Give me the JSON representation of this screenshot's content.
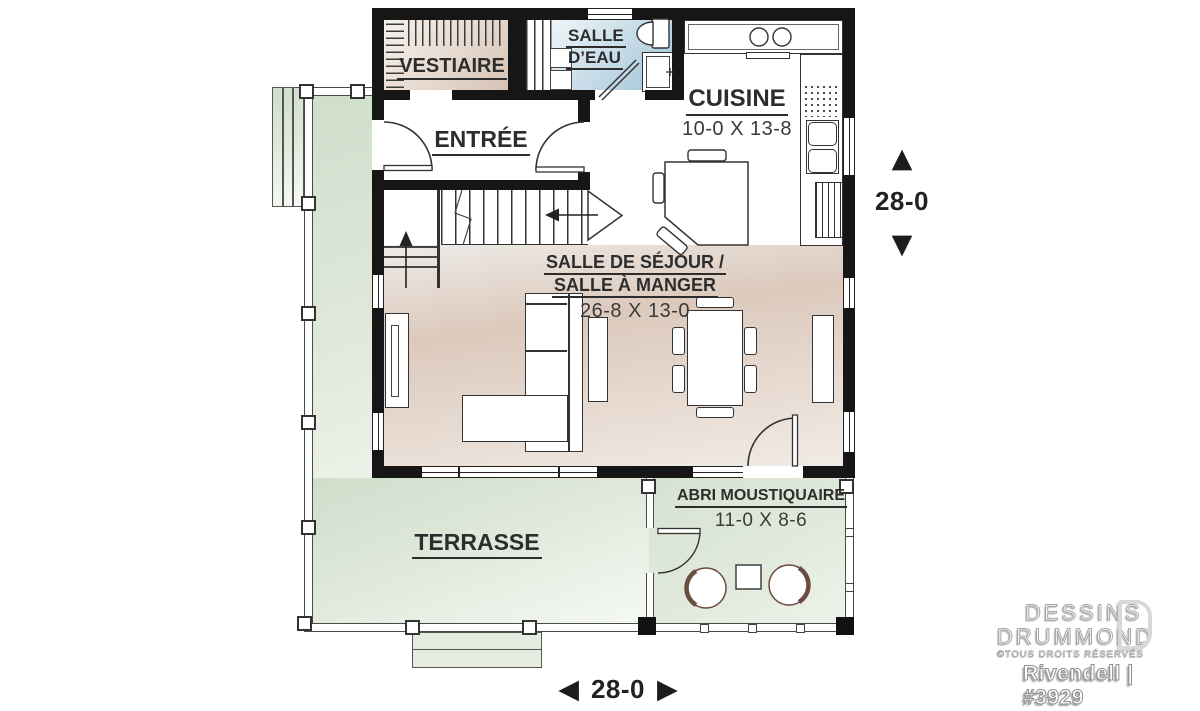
{
  "rooms": {
    "vestiaire": {
      "name": "VESTIAIRE"
    },
    "salle_deau": {
      "line1": "SALLE",
      "line2": "D’EAU"
    },
    "cuisine": {
      "name": "CUISINE",
      "dims": "10-0 X 13-8"
    },
    "entree": {
      "name": "ENTRÉE"
    },
    "sejour": {
      "line1": "SALLE DE SÉJOUR /",
      "line2": "SALLE À MANGER",
      "dims": "26-8 X 13-0"
    },
    "terrasse": {
      "name": "TERRASSE"
    },
    "abri": {
      "name": "ABRI MOUSTIQUAIRE",
      "dims": "11-0 X 8-6"
    }
  },
  "dim_markers": {
    "vertical": {
      "value": "28-0"
    },
    "horizontal": {
      "value": "28-0"
    }
  },
  "icons": {
    "arrow_up": "▲",
    "arrow_down": "▼",
    "arrow_left": "◀",
    "arrow_right": "▶"
  },
  "branding": {
    "company_line1": "DESSINS",
    "company_line2": "DRUMMOND",
    "rights": "©TOUS DROITS RÉSERVÉS",
    "plan_id": "Rivendell | #3929"
  },
  "colors": {
    "wall": "#161616",
    "terrace_green": "#d8e4d3",
    "bath_blue": "#a9cadb",
    "floor_beige": "#ddcabd",
    "porch_chair_accent": "#6b4a40"
  }
}
